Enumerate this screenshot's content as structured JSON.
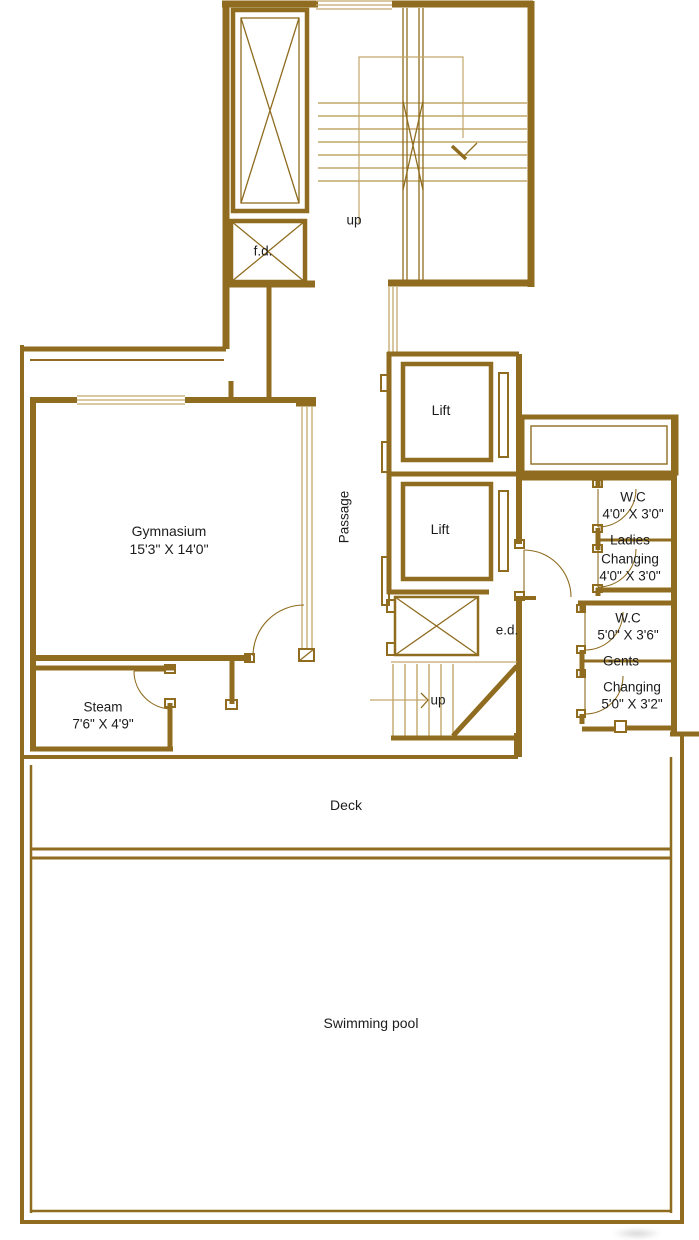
{
  "colors": {
    "wall": "#8f6c1f",
    "wall_light": "#c2a86a",
    "text": "#1c1c1c",
    "background": "#ffffff"
  },
  "rooms": {
    "fd": {
      "label": "f.d."
    },
    "stairs_top": {
      "label": "up"
    },
    "lift_1": {
      "label": "Lift"
    },
    "lift_2": {
      "label": "Lift"
    },
    "passage": {
      "label": "Passage"
    },
    "gymnasium": {
      "label": "Gymnasium",
      "dims": "15'3\" X 14'0\""
    },
    "wc_ladies": {
      "label": "W.C",
      "dims": "4'0\" X 3'0\""
    },
    "ladies": {
      "label": "Ladies"
    },
    "changing_ladies": {
      "label": "Changing",
      "dims": "4'0\" X 3'0\""
    },
    "wc_gents": {
      "label": "W.C",
      "dims": "5'0\" X 3'6\""
    },
    "gents": {
      "label": "Gents"
    },
    "changing_gents": {
      "label": "Changing",
      "dims": "5'0\" X 3'2\""
    },
    "ed": {
      "label": "e.d."
    },
    "stairs_mid": {
      "label": "up"
    },
    "steam": {
      "label": "Steam",
      "dims": "7'6\" X 4'9\""
    },
    "deck": {
      "label": "Deck"
    },
    "swimming_pool": {
      "label": "Swimming pool"
    }
  }
}
